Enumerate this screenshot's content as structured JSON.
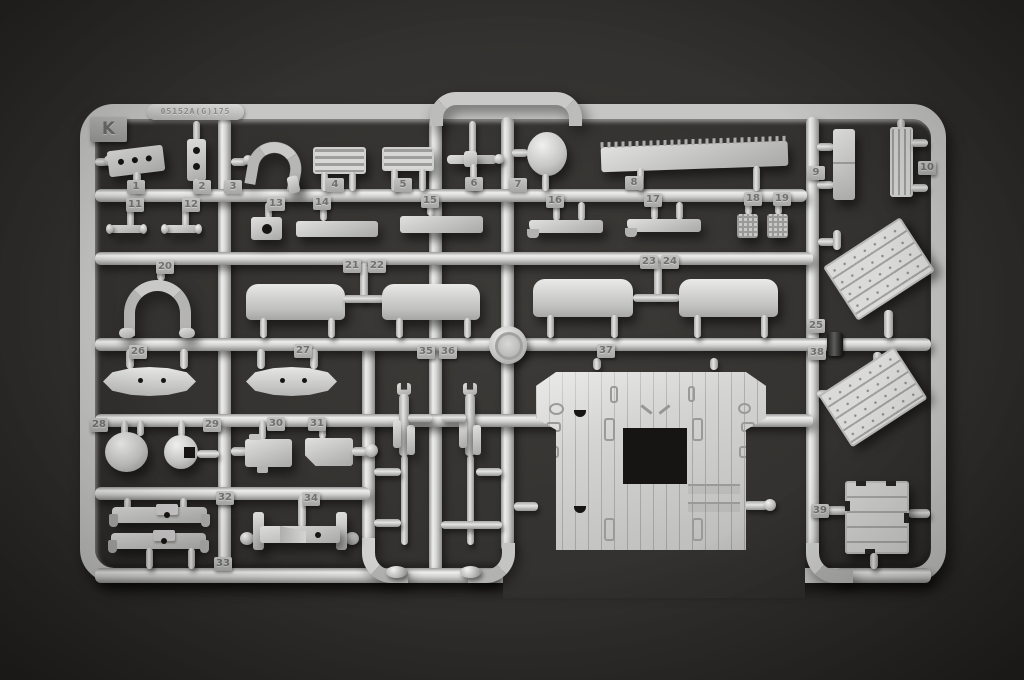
{
  "scene": {
    "type": "photograph",
    "subject": "light-grey injection-molded plastic model kit sprue on dark backdrop",
    "sprue_letter": "K",
    "embossed_code": "05152A(G)175",
    "highest_part_number": 39
  },
  "colors": {
    "background": "#2e2c2a",
    "plastic": "#c8c8c6",
    "plastic_highlight": "#efefed",
    "plastic_shadow": "#84847f",
    "tag_text": "#707070"
  },
  "part_tags": [
    {
      "n": "1",
      "x": 136,
      "y": 187
    },
    {
      "n": "2",
      "x": 202,
      "y": 187
    },
    {
      "n": "3",
      "x": 233,
      "y": 187
    },
    {
      "n": "4",
      "x": 335,
      "y": 185
    },
    {
      "n": "5",
      "x": 403,
      "y": 185
    },
    {
      "n": "6",
      "x": 474,
      "y": 184
    },
    {
      "n": "7",
      "x": 518,
      "y": 185
    },
    {
      "n": "8",
      "x": 634,
      "y": 183
    },
    {
      "n": "9",
      "x": 816,
      "y": 173
    },
    {
      "n": "10",
      "x": 927,
      "y": 168
    },
    {
      "n": "11",
      "x": 135,
      "y": 205
    },
    {
      "n": "12",
      "x": 191,
      "y": 205
    },
    {
      "n": "13",
      "x": 276,
      "y": 204
    },
    {
      "n": "14",
      "x": 322,
      "y": 203
    },
    {
      "n": "15",
      "x": 430,
      "y": 201
    },
    {
      "n": "16",
      "x": 555,
      "y": 201
    },
    {
      "n": "17",
      "x": 653,
      "y": 200
    },
    {
      "n": "18",
      "x": 753,
      "y": 199
    },
    {
      "n": "19",
      "x": 782,
      "y": 199
    },
    {
      "n": "20",
      "x": 165,
      "y": 267
    },
    {
      "n": "21",
      "x": 352,
      "y": 266
    },
    {
      "n": "22",
      "x": 377,
      "y": 266
    },
    {
      "n": "23",
      "x": 649,
      "y": 262
    },
    {
      "n": "24",
      "x": 670,
      "y": 262
    },
    {
      "n": "25",
      "x": 816,
      "y": 326
    },
    {
      "n": "26",
      "x": 138,
      "y": 352
    },
    {
      "n": "27",
      "x": 303,
      "y": 351
    },
    {
      "n": "28",
      "x": 99,
      "y": 425
    },
    {
      "n": "29",
      "x": 212,
      "y": 425
    },
    {
      "n": "30",
      "x": 276,
      "y": 424
    },
    {
      "n": "31",
      "x": 317,
      "y": 424
    },
    {
      "n": "32",
      "x": 225,
      "y": 498
    },
    {
      "n": "33",
      "x": 223,
      "y": 564
    },
    {
      "n": "34",
      "x": 311,
      "y": 499
    },
    {
      "n": "35",
      "x": 426,
      "y": 352
    },
    {
      "n": "36",
      "x": 448,
      "y": 352
    },
    {
      "n": "37",
      "x": 606,
      "y": 351
    },
    {
      "n": "38",
      "x": 817,
      "y": 353
    },
    {
      "n": "39",
      "x": 820,
      "y": 511
    }
  ],
  "parts": [
    {
      "n": 1,
      "desc": "perforated tapered bracket"
    },
    {
      "n": 2,
      "desc": "small plate with two holes"
    },
    {
      "n": 3,
      "desc": "curved intake duct"
    },
    {
      "n": 4,
      "desc": "louvered grille panel"
    },
    {
      "n": 5,
      "desc": "louvered grille panel"
    },
    {
      "n": 6,
      "desc": "axle shaft with collar"
    },
    {
      "n": 7,
      "desc": "dome blister"
    },
    {
      "n": 8,
      "desc": "long serrated tread plank"
    },
    {
      "n": 9,
      "desc": "flat panel"
    },
    {
      "n": 10,
      "desc": "ribbed panel"
    },
    {
      "n": 11,
      "desc": "small tee fitting"
    },
    {
      "n": 12,
      "desc": "small tee fitting"
    },
    {
      "n": 13,
      "desc": "small block with opening"
    },
    {
      "n": 14,
      "desc": "low rectangular tray"
    },
    {
      "n": 15,
      "desc": "low rectangular tray"
    },
    {
      "n": 16,
      "desc": "angled blade bracket"
    },
    {
      "n": 17,
      "desc": "angled blade bracket"
    },
    {
      "n": 18,
      "desc": "small treaded pedal plate"
    },
    {
      "n": 19,
      "desc": "small treaded pedal plate"
    },
    {
      "n": 20,
      "desc": "U-shaped hoop"
    },
    {
      "n": 21,
      "desc": "curved bulwark panel"
    },
    {
      "n": 22,
      "desc": "curved bulwark panel"
    },
    {
      "n": 23,
      "desc": "curved bulwark panel"
    },
    {
      "n": 24,
      "desc": "curved bulwark panel"
    },
    {
      "n": 25,
      "desc": "slanted planked door panel with rivets"
    },
    {
      "n": 26,
      "desc": "lens-shaped fairing"
    },
    {
      "n": 27,
      "desc": "lens-shaped fairing"
    },
    {
      "n": 28,
      "desc": "hemispherical bowl"
    },
    {
      "n": 29,
      "desc": "sphere with square opening"
    },
    {
      "n": 30,
      "desc": "rectangular mount block"
    },
    {
      "n": 31,
      "desc": "rectangular mount block"
    },
    {
      "n": 32,
      "desc": "cross beam with center boss"
    },
    {
      "n": 33,
      "desc": "cross beam with center boss"
    },
    {
      "n": 34,
      "desc": "cross beam with end plates"
    },
    {
      "n": 35,
      "desc": "mast davit assembly"
    },
    {
      "n": 36,
      "desc": "mast davit assembly"
    },
    {
      "n": 37,
      "desc": "large planked deck panel with square opening"
    },
    {
      "n": 38,
      "desc": "slanted planked door panel with rivets"
    },
    {
      "n": 39,
      "desc": "planked hatch panel"
    }
  ]
}
